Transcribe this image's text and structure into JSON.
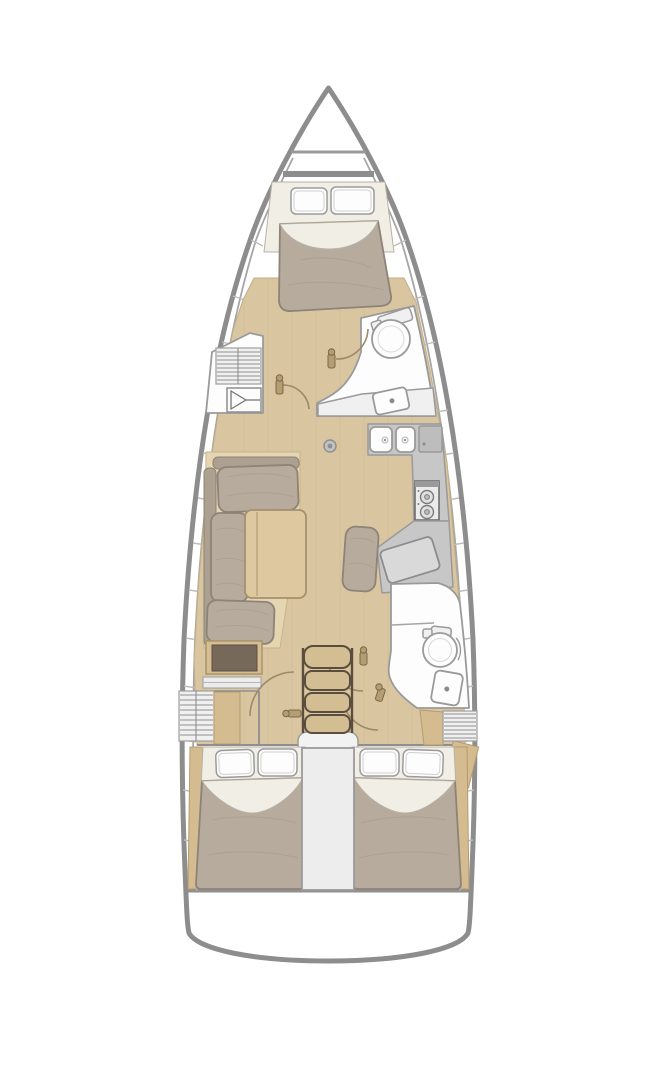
{
  "diagram": {
    "type": "yacht-floor-plan",
    "orientation": "bow-up",
    "text_labels": [],
    "areas": [
      {
        "name": "anchor-locker",
        "location": "bow"
      },
      {
        "name": "forward-owner-cabin",
        "contents": [
          "double-v-berth",
          "two-pillows",
          "blanket"
        ]
      },
      {
        "name": "forward-head",
        "contents": [
          "toilet",
          "sink",
          "vanity-counter",
          "door"
        ]
      },
      {
        "name": "port-wardrobe-locker",
        "contents": [
          "louvered-locker",
          "cabinet-symbol"
        ]
      },
      {
        "name": "saloon",
        "contents": [
          "l-shaped-sofa",
          "dining-table",
          "cabinet",
          "shelf"
        ]
      },
      {
        "name": "galley",
        "contents": [
          "double-sink",
          "top-loading-fridge",
          "two-burner-stove",
          "counter"
        ]
      },
      {
        "name": "navigation-station",
        "contents": [
          "chart-table",
          "seat-cushion"
        ]
      },
      {
        "name": "aft-head",
        "contents": [
          "shower-stall",
          "toilet",
          "sink",
          "doors"
        ]
      },
      {
        "name": "companionway",
        "contents": [
          "four-steps",
          "landing"
        ]
      },
      {
        "name": "engine-compartment",
        "location": "between-aft-cabins"
      },
      {
        "name": "port-aft-cabin",
        "contents": [
          "double-berth",
          "two-pillows",
          "blanket"
        ]
      },
      {
        "name": "starboard-aft-cabin",
        "contents": [
          "double-berth",
          "two-pillows",
          "blanket"
        ]
      },
      {
        "name": "transom",
        "location": "stern"
      }
    ],
    "counts": {
      "cabins": 3,
      "heads": 2,
      "berths": 3,
      "stair_steps": 4,
      "stove_burners": 2,
      "galley_sinks": 2
    }
  },
  "palette": {
    "background": "#ffffff",
    "hull_outline": "#8d8d8d",
    "inner_wall": "#a6a6a6",
    "floor_wood": "#d9c6a0",
    "floor_grain": "#cbb68c",
    "trim_wood": "#d5bc90",
    "upholstery": "#b7ab9d",
    "upholstery_outline": "#8d8377",
    "linen": "#f1eee6",
    "pillow": "#fdfdfd",
    "white_room": "#fdfdfd",
    "fixture_outline": "#9a9a9a",
    "counter_gray": "#c7c7c7",
    "nav_table": "#d9d9d9",
    "stove_body": "#ebebeb",
    "stairs_wood": "#d3bd92",
    "stairs_outline": "#5a4d3d",
    "table_wood": "#ddc89f",
    "table_outline": "#a3916f",
    "cabinet_inset": "#77695a",
    "door_arc": "#9b8b6b",
    "door_handle": "#b59d72",
    "engine_box": "#ededed"
  }
}
